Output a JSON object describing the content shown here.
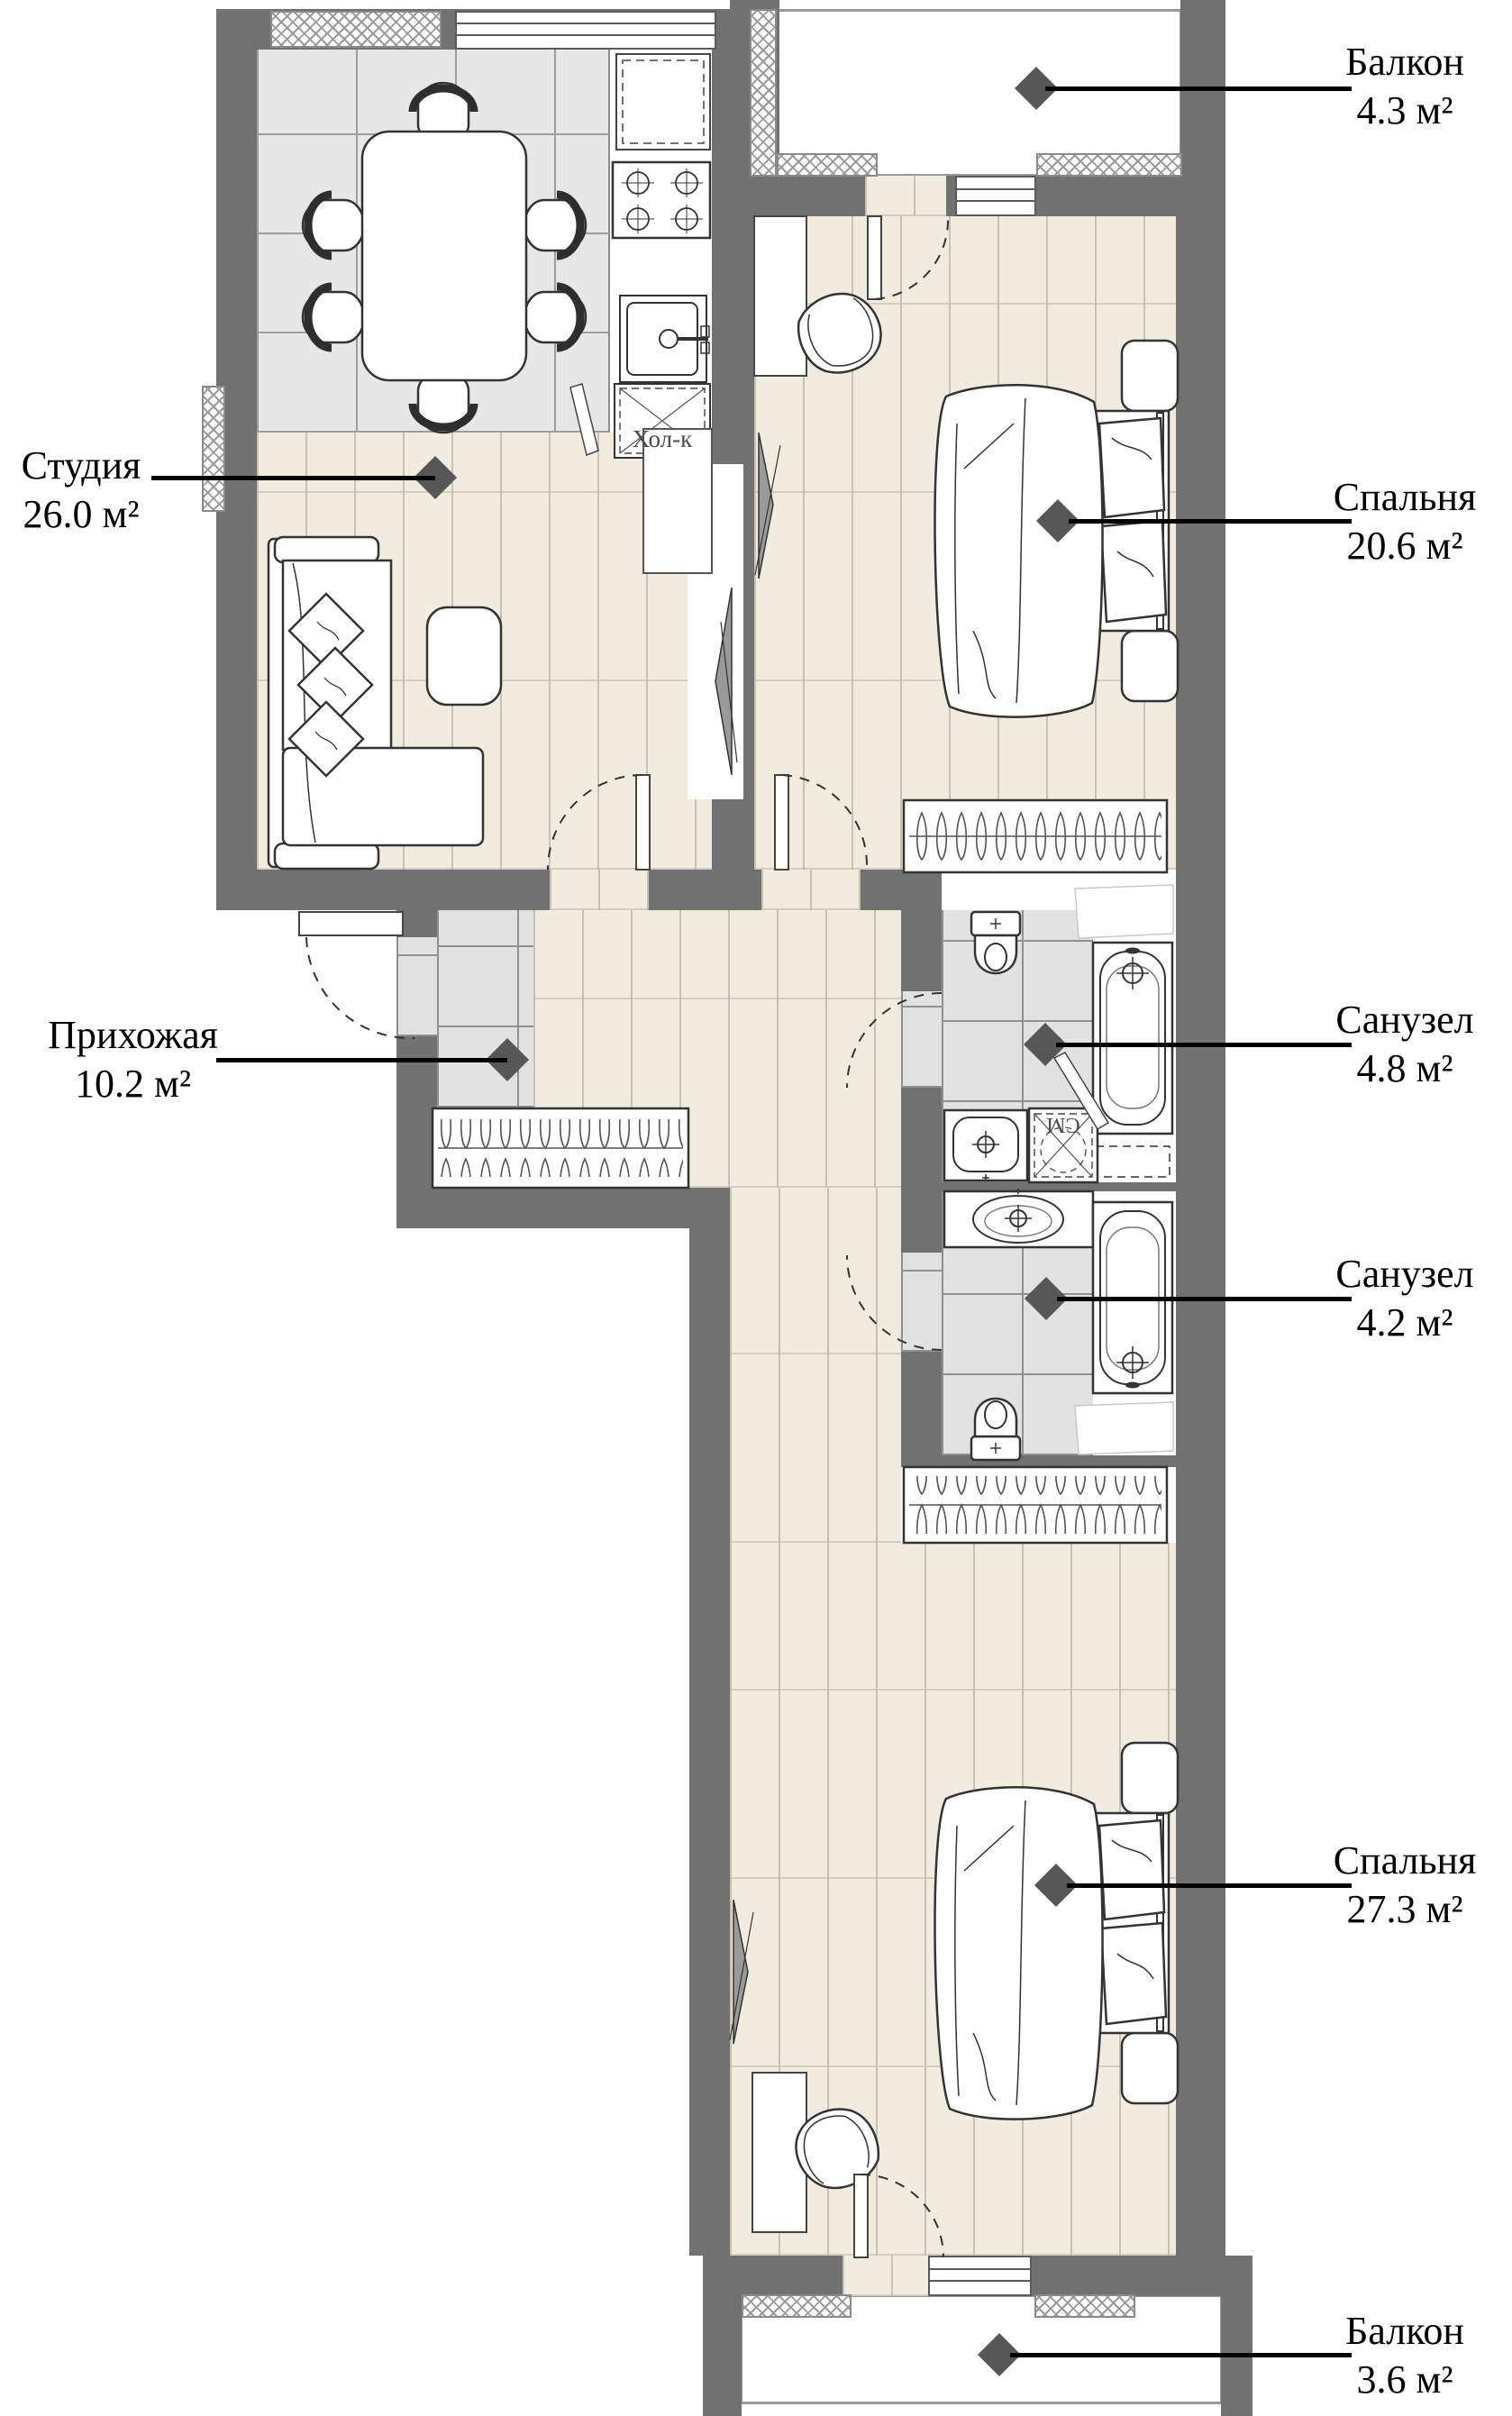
{
  "plan": {
    "title": "Apartment floor plan",
    "rooms": [
      {
        "id": "balcony-top",
        "name": "Балкон",
        "area": "4.3 м²"
      },
      {
        "id": "studio",
        "name": "Студия",
        "area": "26.0 м²"
      },
      {
        "id": "bedroom-top",
        "name": "Спальня",
        "area": "20.6 м²"
      },
      {
        "id": "hallway",
        "name": "Прихожая",
        "area": "10.2 м²"
      },
      {
        "id": "bathroom-top",
        "name": "Санузел",
        "area": "4.8 м²"
      },
      {
        "id": "bathroom-bottom",
        "name": "Санузел",
        "area": "4.2 м²"
      },
      {
        "id": "bedroom-bottom",
        "name": "Спальня",
        "area": "27.3 м²"
      },
      {
        "id": "balcony-bottom",
        "name": "Балкон",
        "area": "3.6 м²"
      }
    ],
    "annotations": {
      "fridge": "Хол-к",
      "washing_machine": "СМ"
    },
    "colors": {
      "wall": "#717171",
      "wood_floor": "#f2ebe0",
      "tile_floor": "#e2e2e2",
      "marker": "#575757"
    }
  }
}
